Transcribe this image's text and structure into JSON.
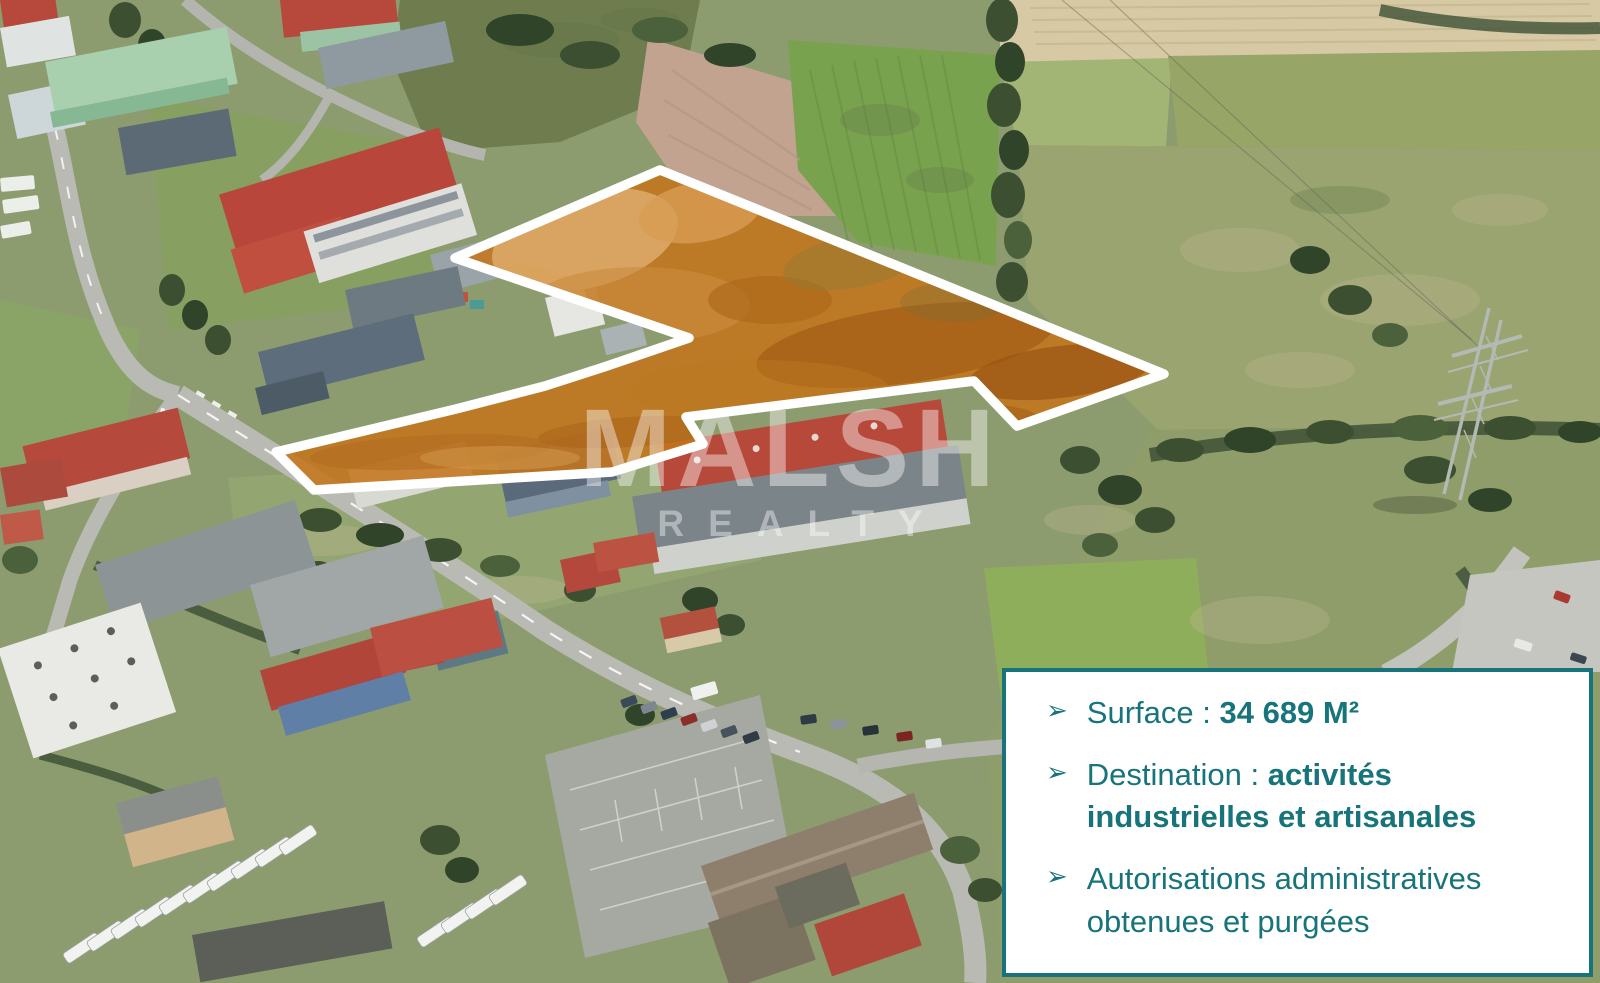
{
  "watermark": {
    "brand": "MALSH",
    "subtitle": "REALTY",
    "color": "rgba(255,255,255,0.42)"
  },
  "info_box": {
    "background": "#ffffff",
    "border_color": "#17747b",
    "text_color": "#17747b",
    "bullet_glyph": "➢",
    "items": [
      {
        "text": "Surface : ",
        "bold_text": "34 689 M²"
      },
      {
        "text": "Destination : ",
        "bold_text": "activités industrielles et artisanales"
      },
      {
        "text": "Autorisations administratives obtenues et purgées",
        "bold_text": ""
      }
    ]
  },
  "parcel": {
    "fill_color": "#c4751c",
    "outline_color": "#ffffff",
    "outline_points": "660,170 952,288 1164,374 1017,426 974,381 686,417 703,444 612,472 314,490 276,452 456,409 545,386 604,367 689,338 455,258"
  }
}
